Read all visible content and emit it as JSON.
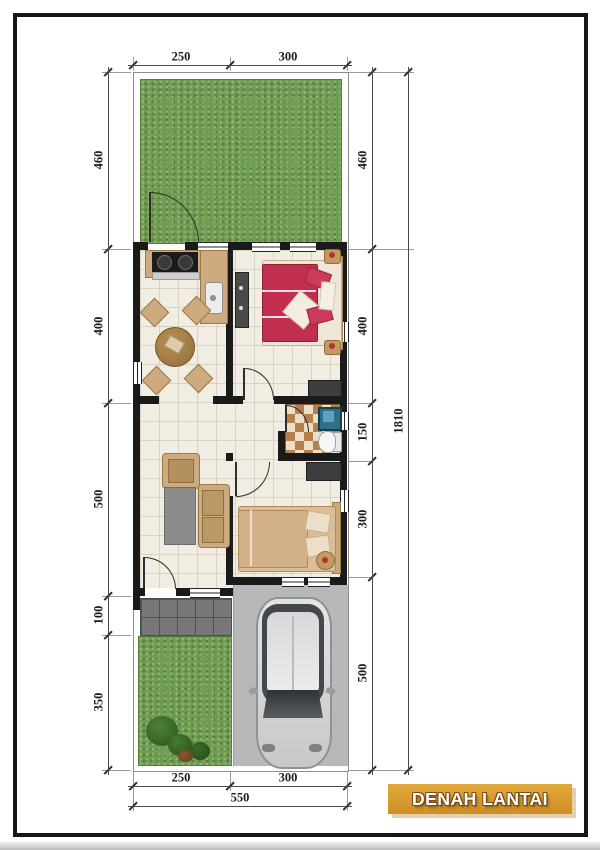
{
  "title_block": {
    "label": "DENAH LANTAI"
  },
  "dimensions": {
    "top": [
      "250",
      "300"
    ],
    "left": [
      "460",
      "400",
      "500",
      "100",
      "350"
    ],
    "right": [
      "460",
      "400",
      "150",
      "300",
      "500"
    ],
    "overall_height": "1810",
    "bottom": [
      "250",
      "300"
    ],
    "bottom_total": "550"
  },
  "colors": {
    "accent_gold": "#d89a2e",
    "grass_green": "#6f9b52",
    "wall_black": "#1a1a1a",
    "bed_red": "#c22e4e",
    "floor_cream": "#f1ede2",
    "driveway_gray": "#b6b8ba"
  }
}
